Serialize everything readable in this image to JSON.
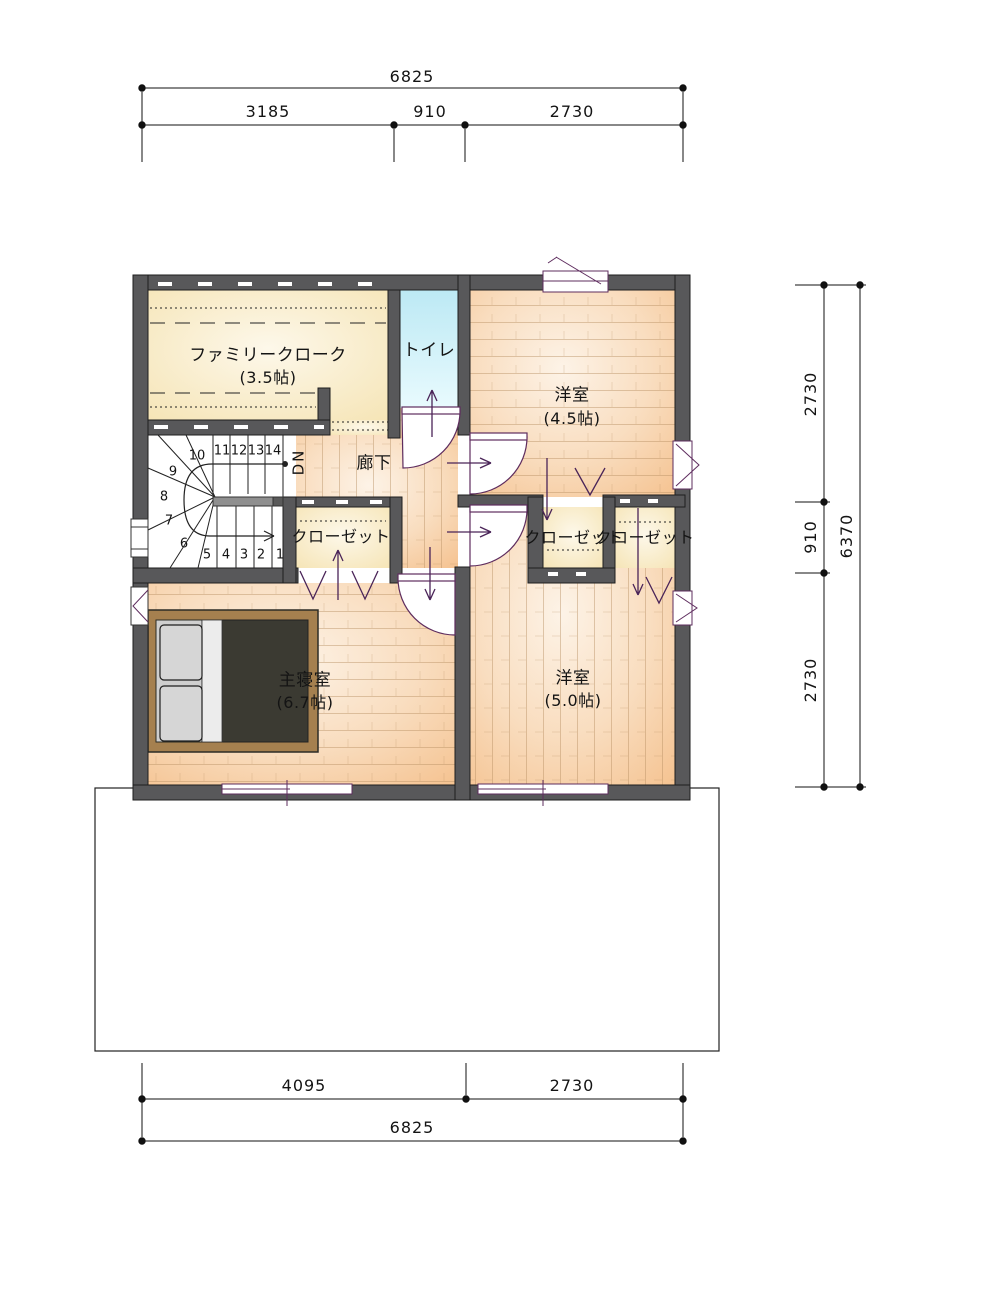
{
  "plan": {
    "rooms": {
      "family_cloak": {
        "name": "ファミリークローク",
        "size": "(3.5帖)"
      },
      "toilet": {
        "name": "トイレ"
      },
      "western_room_45": {
        "name": "洋室",
        "size": "(4.5帖)"
      },
      "corridor": {
        "name": "廊下"
      },
      "closet_west": {
        "name": "クローゼット"
      },
      "closet_center": {
        "name": "クローゼット"
      },
      "closet_east": {
        "name": "クローゼット"
      },
      "master_bedroom": {
        "name": "主寝室",
        "size": "(6.7帖)"
      },
      "western_room_50": {
        "name": "洋室",
        "size": "(5.0帖)"
      }
    },
    "stairs": {
      "dn_label": "DN",
      "numbers": [
        "1",
        "2",
        "3",
        "4",
        "5",
        "6",
        "7",
        "8",
        "9",
        "10",
        "11",
        "12",
        "13",
        "14"
      ]
    }
  },
  "dimensions": {
    "top": {
      "total": "6825",
      "segments": [
        "3185",
        "910",
        "2730"
      ]
    },
    "bottom": {
      "segments": [
        "4095",
        "2730"
      ],
      "total": "6825"
    },
    "right": {
      "segments": [
        "2730",
        "910",
        "2730"
      ],
      "total": "6370"
    }
  },
  "colors": {
    "wall": "#58585a",
    "wood_floor": "#f5c493",
    "wood_floor_light": "#fdf3e7",
    "cream_floor": "#f5e3b2",
    "cream_floor_light": "#fdf8ea",
    "toilet_floor": "#bce9f4",
    "door_symbol": "#5e2c5e",
    "arrow": "#4a2458",
    "bed_frame": "#a5804f",
    "bed_mattress": "#3b3a32",
    "bed_pillow": "#d6d6d6",
    "handrail": "#8f8f8f",
    "dimension_line": "#111111"
  }
}
